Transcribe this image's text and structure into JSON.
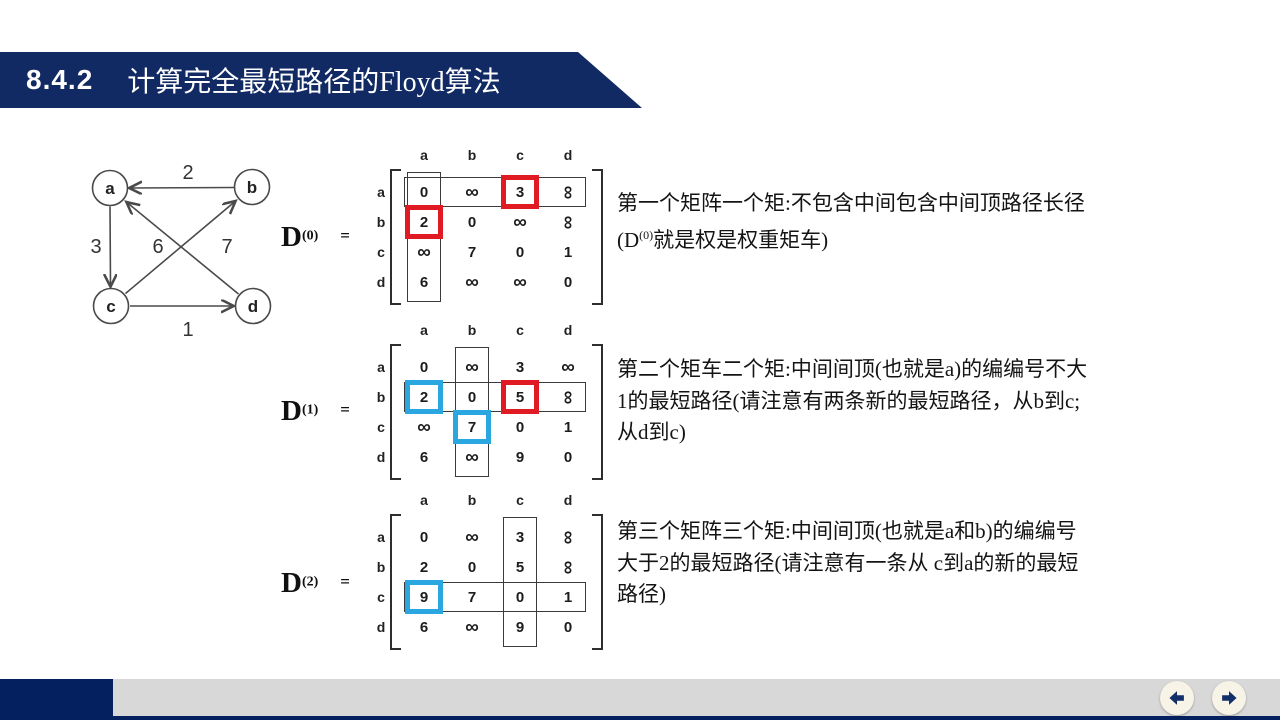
{
  "header": {
    "number": "8.4.2",
    "title": "计算完全最短路径的Floyd算法"
  },
  "graph": {
    "nodes": [
      {
        "label": "a"
      },
      {
        "label": "b"
      },
      {
        "label": "c"
      },
      {
        "label": "d"
      }
    ],
    "edges": [
      {
        "from": "b",
        "to": "a",
        "weight": "2"
      },
      {
        "from": "a",
        "to": "c",
        "weight": "3"
      },
      {
        "from": "d",
        "to": "a",
        "weight": "6"
      },
      {
        "from": "c",
        "to": "b",
        "weight": "7"
      },
      {
        "from": "c",
        "to": "d",
        "weight": "1"
      }
    ]
  },
  "matrices": [
    {
      "name": "D",
      "sup": "(0)",
      "equals": "=",
      "col_headers": [
        "a",
        "b",
        "c",
        "d"
      ],
      "row_headers": [
        "a",
        "b",
        "c",
        "d"
      ],
      "cells": [
        [
          "0",
          "∞",
          "3",
          "∞"
        ],
        [
          "2",
          "0",
          "∞",
          "∞"
        ],
        [
          "∞",
          "7",
          "0",
          "1"
        ],
        [
          "6",
          "∞",
          "∞",
          "0"
        ]
      ],
      "row_outline": 0,
      "col_outline": 0,
      "highlight_boxes": [
        {
          "row": 0,
          "col": 2,
          "color": "red"
        },
        {
          "row": 1,
          "col": 0,
          "color": "red"
        }
      ],
      "rotated_cells": [
        [
          0,
          3
        ],
        [
          1,
          3
        ]
      ]
    },
    {
      "name": "D",
      "sup": "(1)",
      "equals": "=",
      "col_headers": [
        "a",
        "b",
        "c",
        "d"
      ],
      "row_headers": [
        "a",
        "b",
        "c",
        "d"
      ],
      "cells": [
        [
          "0",
          "∞",
          "3",
          "∞"
        ],
        [
          "2",
          "0",
          "5",
          "∞"
        ],
        [
          "∞",
          "7",
          "0",
          "1"
        ],
        [
          "6",
          "∞",
          "9",
          "0"
        ]
      ],
      "row_outline": 1,
      "col_outline": 1,
      "highlight_boxes": [
        {
          "row": 1,
          "col": 0,
          "color": "blue"
        },
        {
          "row": 1,
          "col": 2,
          "color": "red"
        },
        {
          "row": 2,
          "col": 1,
          "color": "blue"
        }
      ],
      "rotated_cells": [
        [
          1,
          3
        ]
      ]
    },
    {
      "name": "D",
      "sup": "(2)",
      "equals": "=",
      "col_headers": [
        "a",
        "b",
        "c",
        "d"
      ],
      "row_headers": [
        "a",
        "b",
        "c",
        "d"
      ],
      "cells": [
        [
          "0",
          "∞",
          "3",
          "∞"
        ],
        [
          "2",
          "0",
          "5",
          "∞"
        ],
        [
          "9",
          "7",
          "0",
          "1"
        ],
        [
          "6",
          "∞",
          "9",
          "0"
        ]
      ],
      "row_outline": 2,
      "col_outline": 2,
      "highlight_boxes": [
        {
          "row": 2,
          "col": 0,
          "color": "blue"
        }
      ],
      "rotated_cells": [
        [
          0,
          3
        ],
        [
          1,
          3
        ]
      ]
    }
  ],
  "notes": [
    {
      "lines": [
        [
          {
            "t": "第一个矩阵一个矩:不包含中间包含中间顶路径长径"
          }
        ],
        [
          {
            "t": "(D"
          },
          {
            "t": "(0)",
            "sup": true
          },
          {
            "t": "就是权是权重矩车)"
          }
        ]
      ]
    },
    {
      "lines": [
        [
          {
            "t": "第二个矩车二个矩:中间间顶(也就是a)的编编号不大"
          }
        ],
        [
          {
            "t": "1的最短路径(请注意有两条新的最短路径，从b到c;"
          }
        ],
        [
          {
            "t": "从d到c)"
          }
        ]
      ]
    },
    {
      "lines": [
        [
          {
            "t": "第三个矩阵三个矩:中间间顶(也就是a和b)的编编号"
          }
        ],
        [
          {
            "t": "大于2的最短路径(请注意有一条从 c到a的新的最短"
          }
        ],
        [
          {
            "t": "路径)"
          }
        ]
      ]
    }
  ],
  "nav": {
    "prev_icon": "left-arrow-icon",
    "next_icon": "right-arrow-icon"
  },
  "colors": {
    "navy": "#122a64",
    "navy_dark": "#04205f",
    "red": "#e01b24",
    "blue": "#2aa7e0",
    "gray_bar": "#d8d8d8",
    "button_bg": "#f7f3e6"
  }
}
